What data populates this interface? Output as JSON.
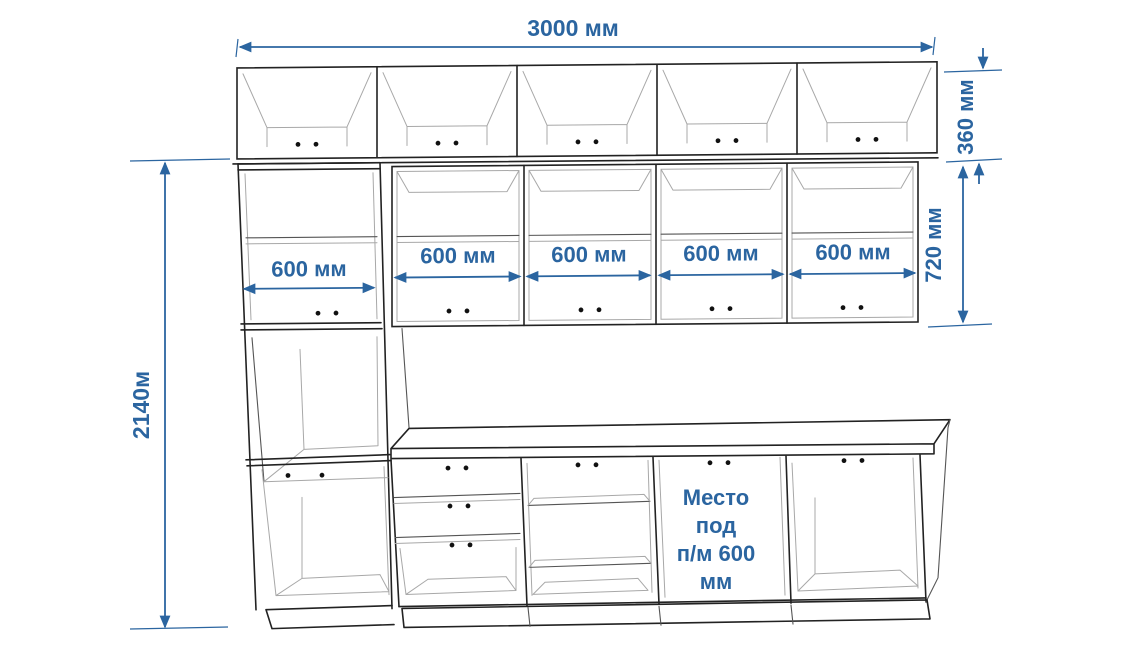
{
  "diagram": {
    "type": "kitchen-elevation-drawing",
    "colors": {
      "dimension": "#2B65A0",
      "outline": "#222222",
      "background": "#ffffff"
    },
    "labels": {
      "total_width": "3000 мм",
      "upper_cabinet_height": "360 мм",
      "wall_cabinet_height": "720 мм",
      "total_height": "2140м",
      "tall_cabinet_width": "600 мм",
      "wall_cabinet_widths": [
        "600 мм",
        "600 мм",
        "600 мм",
        "600 мм"
      ]
    },
    "dishwasher_note_lines": [
      "Место",
      "под",
      "п/м 600",
      "мм"
    ]
  }
}
